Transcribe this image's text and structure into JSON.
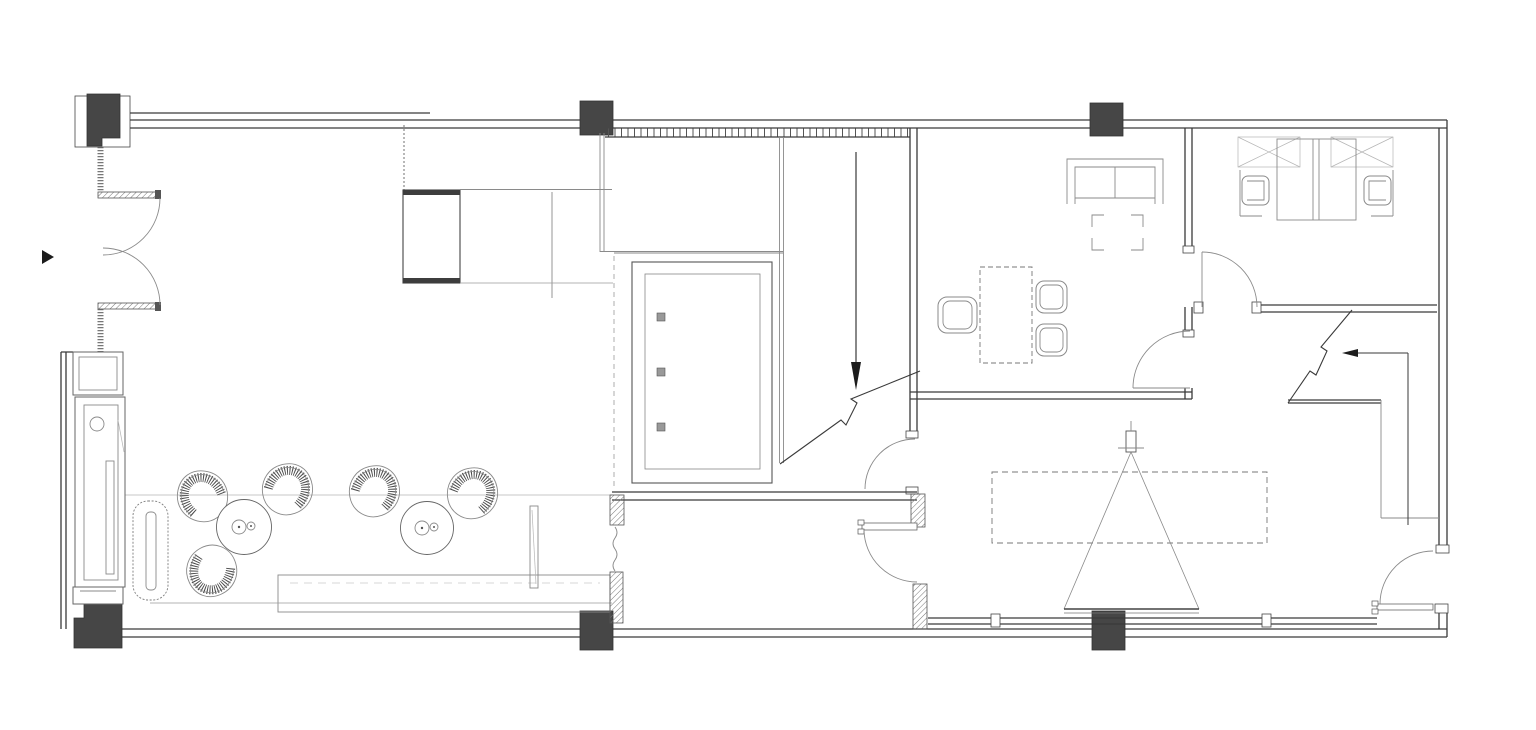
{
  "drawing": {
    "type": "floor-plan",
    "labels": {
      "entrance": "入口",
      "hall": "大厅",
      "shoe_change_area": "换鞋区",
      "light_pool": "灯光景池",
      "light_pool_note": "（专业厂家深化设计）",
      "shoe_storage": "鞋库",
      "storage_room": "储藏室",
      "manager_office": "经理办公室",
      "finance_room": "财务室",
      "meeting_room": "会议室",
      "up": "上",
      "led": "LED"
    },
    "colors": {
      "background": "#ffffff",
      "wall": "#3a3a3a",
      "furniture": "#8a8a8a",
      "column_fill": "#464646",
      "text": "#1c1c1c",
      "led_text": "#858585"
    }
  }
}
